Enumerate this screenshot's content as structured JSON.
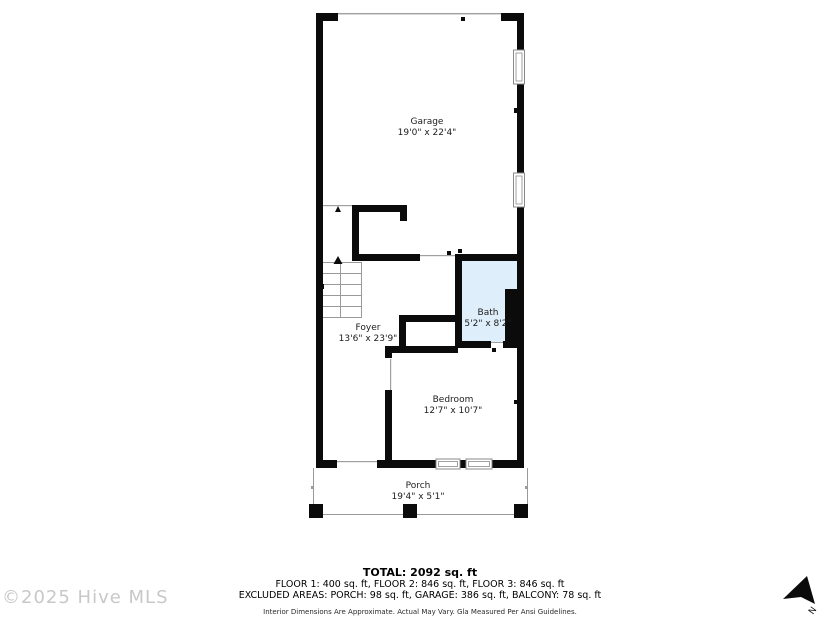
{
  "rooms": {
    "garage": {
      "name": "Garage",
      "dims": "19'0\" x 22'4\""
    },
    "foyer": {
      "name": "Foyer",
      "dims": "13'6\" x 23'9\""
    },
    "bath": {
      "name": "Bath",
      "dims": "5'2\" x 8'2\""
    },
    "bedroom": {
      "name": "Bedroom",
      "dims": "12'7\" x 10'7\""
    },
    "porch": {
      "name": "Porch",
      "dims": "19'4\" x 5'1\""
    }
  },
  "summary": {
    "total": "TOTAL: 2092 sq. ft",
    "floors": "FLOOR 1: 400 sq. ft, FLOOR 2: 846 sq. ft, FLOOR 3: 846 sq. ft",
    "excluded": "EXCLUDED AREAS: PORCH: 98 sq. ft, GARAGE: 386 sq. ft, BALCONY: 78 sq. ft",
    "disclaimer": "Interior Dimensions Are Approximate. Actual May Vary. Gla Measured Per Ansi Guidelines."
  },
  "watermark": "©2025 Hive MLS",
  "compass": {
    "label": "N"
  },
  "colors": {
    "wall": "#0b0b0b",
    "bath_fill": "#deeefa",
    "thin_line": "#a0a0a0",
    "watermark": "#c8c8c8"
  }
}
